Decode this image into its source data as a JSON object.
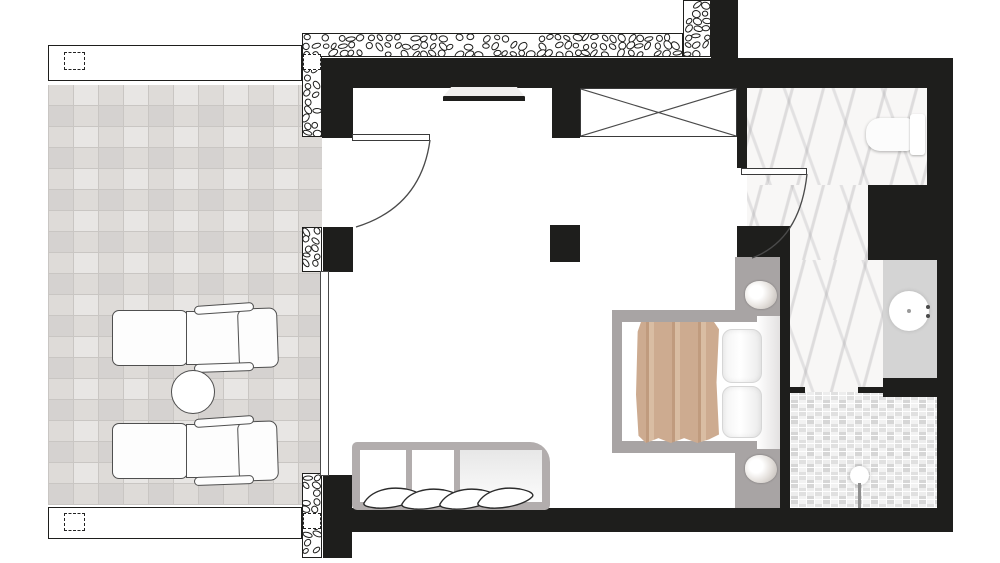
{
  "title": "Hotel suite floor plan",
  "plan": {
    "kind": "architectural floor plan, top view",
    "rooms": [
      "terrace",
      "bedroom",
      "bathroom",
      "shower"
    ]
  },
  "palette": {
    "wall": "#1e1e1c",
    "terrace_tile": "#dedbd8",
    "tile_line": "#c9c6c3",
    "marble_base": "#f8f7f6",
    "mosaic_base": "#e9e9e9",
    "niche_gray": "#a8a4a4",
    "counter_gray": "#d4d4d4",
    "bench_gray": "#b2adad",
    "blanket": "#cdab90",
    "blanket_dark": "#c09b7e",
    "blanket_light": "#d9bda3"
  },
  "items": {
    "terrace": [
      "sun-lounger",
      "sun-lounger",
      "round-side-table",
      "railing",
      "railing-posts",
      "sliding-glass-door"
    ],
    "bedroom": [
      "double-bed",
      "bed-pillows",
      "blanket",
      "wall-sconce",
      "wall-sconce",
      "bench-daybed",
      "bench-pillows",
      "wardrobe",
      "wall-tv",
      "entry-door"
    ],
    "bathroom": [
      "wall-hung-toilet",
      "washbasin-counter",
      "round-sink",
      "faucet",
      "bathroom-door",
      "shower-area",
      "shower-head"
    ]
  }
}
